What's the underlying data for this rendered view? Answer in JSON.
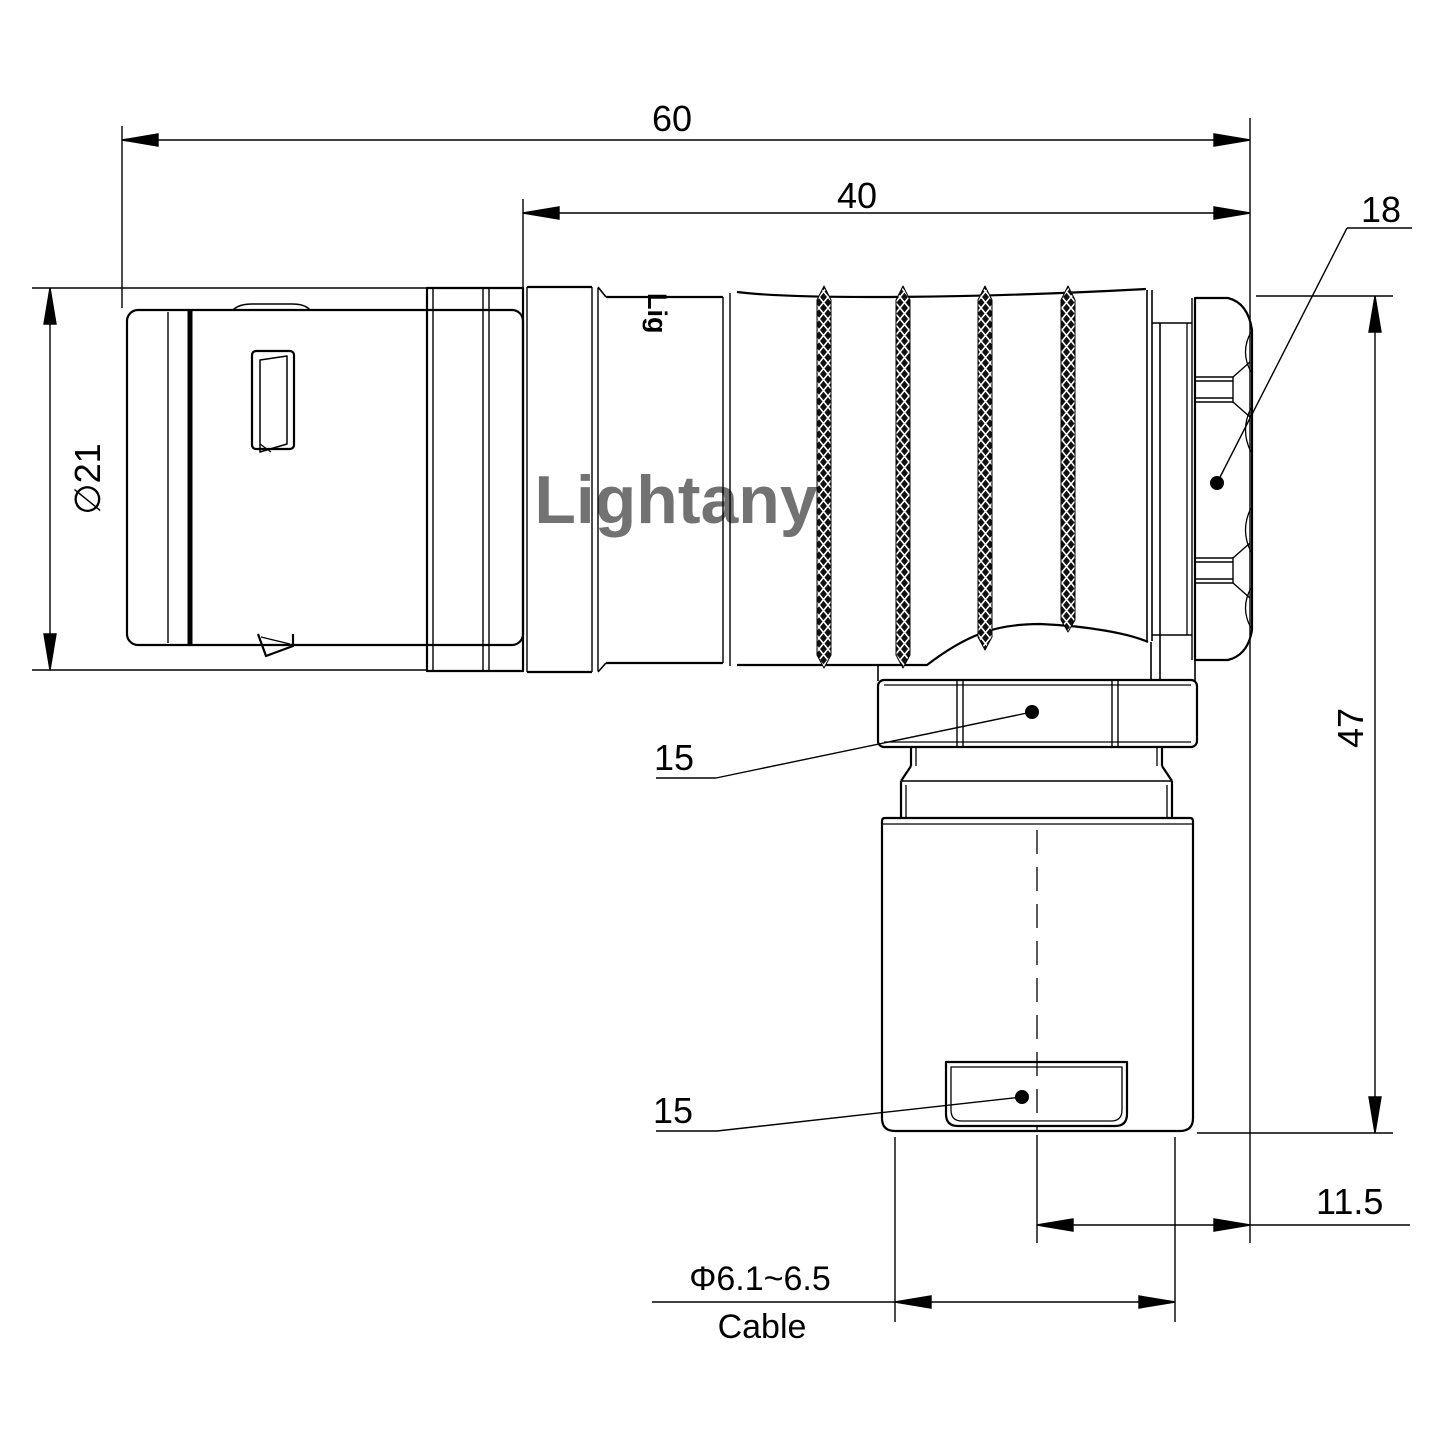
{
  "drawing": {
    "type": "technical-dimension-drawing",
    "subject": "right-angle circular push-pull connector, side elevation",
    "background_color": "#ffffff",
    "line_color": "#000000",
    "watermark": {
      "text": "Lightany",
      "color": "#f2c6c6"
    },
    "part_logo": {
      "text": "Lig"
    },
    "dimensions": {
      "overall_length": {
        "value": "60"
      },
      "rear_length": {
        "value": "40"
      },
      "nut_diameter": {
        "value": "18"
      },
      "body_diameter": {
        "value": "∅21"
      },
      "height": {
        "value": "47"
      },
      "coupling_flats_top": {
        "value": "15"
      },
      "coupling_flats_bottom": {
        "value": "15"
      },
      "exit_offset": {
        "value": "11.5"
      },
      "cable_range": {
        "value": "Φ6.1~6.5"
      },
      "cable_label": {
        "value": "Cable"
      }
    }
  }
}
